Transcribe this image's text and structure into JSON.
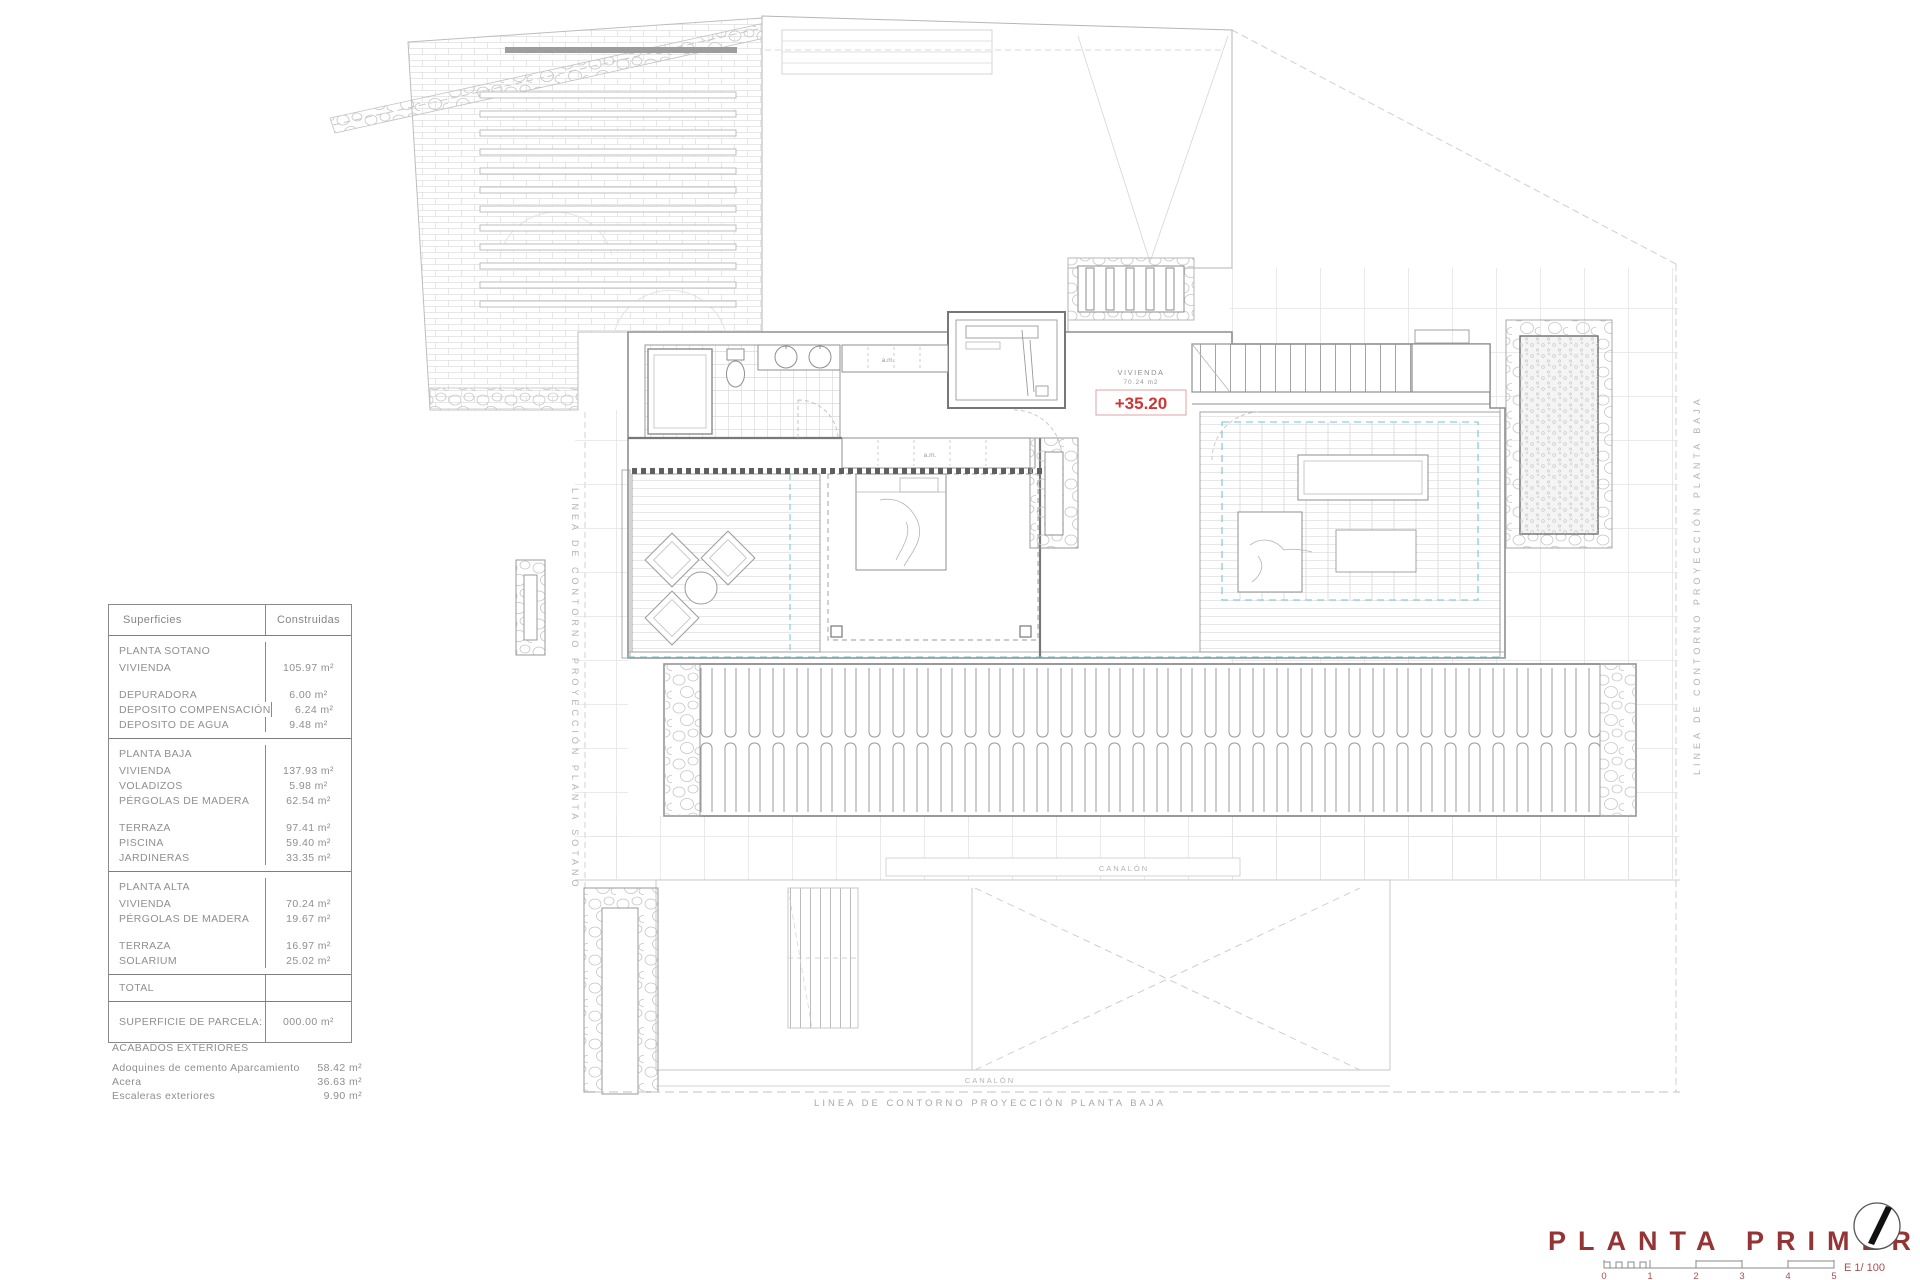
{
  "colors": {
    "level_mark_red": "#cf3535",
    "title_red": "#953434",
    "scale_red": "#a85050",
    "projection_cyan": "#6fc7ce",
    "linework_gray": "#9a9a9a"
  },
  "table": {
    "header_label": "Superficies",
    "header_value": "Construidas",
    "rows": [
      {
        "label": "PLANTA SOTANO",
        "value": ""
      },
      {
        "label": "VIVIENDA",
        "value": "105.97 m²"
      },
      {
        "label": "DEPURADORA",
        "value": "6.00 m²"
      },
      {
        "label": "DEPOSITO COMPENSACIÓN",
        "value": "6.24 m²"
      },
      {
        "label": "DEPOSITO DE AGUA",
        "value": "9.48 m²"
      },
      {
        "label": "PLANTA BAJA",
        "value": ""
      },
      {
        "label": "VIVIENDA",
        "value": "137.93 m²"
      },
      {
        "label": "VOLADIZOS",
        "value": "5.98 m²"
      },
      {
        "label": "PÉRGOLAS DE MADERA",
        "value": "62.54 m²"
      },
      {
        "label": "TERRAZA",
        "value": "97.41 m²"
      },
      {
        "label": "PISCINA",
        "value": "59.40 m²"
      },
      {
        "label": "JARDINERAS",
        "value": "33.35 m²"
      },
      {
        "label": "PLANTA ALTA",
        "value": ""
      },
      {
        "label": "VIVIENDA",
        "value": "70.24 m²"
      },
      {
        "label": "PÉRGOLAS DE MADERA",
        "value": "19.67 m²"
      },
      {
        "label": "TERRAZA",
        "value": "16.97 m²"
      },
      {
        "label": "SOLARIUM",
        "value": "25.02 m²"
      },
      {
        "label": "TOTAL",
        "value": ""
      },
      {
        "label": "SUPERFICIE DE PARCELA:",
        "value": "000.00 m²"
      }
    ]
  },
  "exteriores": {
    "title": "ACABADOS EXTERIORES",
    "rows": [
      {
        "label": "Adoquines de cemento Aparcamiento",
        "value": "58.42 m²"
      },
      {
        "label": "Acera",
        "value": "36.63 m²"
      },
      {
        "label": "Escaleras exteriores",
        "value": "9.90 m²"
      }
    ]
  },
  "plan": {
    "contour_sotano": "LINEA DE CONTORNO PROYECCIÓN PLANTA SOTANO",
    "contour_baja_right": "LINEA DE CONTORNO PROYECCIÓN PLANTA BAJA",
    "contour_baja_bottom": "LINEA DE CONTORNO PROYECCIÓN PLANTA BAJA",
    "canalon": "CANALÓN",
    "room_label": "VIVIENDA",
    "room_area": "70.24 m2",
    "level_mark": "+35.20",
    "closet_label": "a.m."
  },
  "titleblock": {
    "title": "PLANTA PRIMERA",
    "scale_text": "E 1/ 100",
    "scale_ticks": [
      "0",
      "1",
      "2",
      "3",
      "4",
      "5"
    ]
  }
}
